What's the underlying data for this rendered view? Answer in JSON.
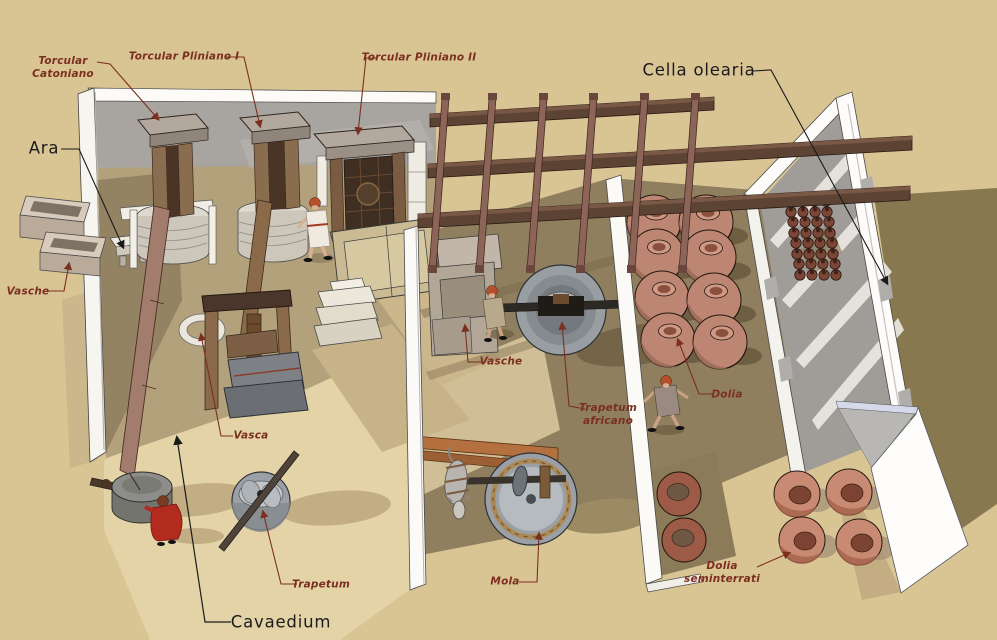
{
  "labels": {
    "torcular_catoniano": {
      "line1": "Torcular",
      "line2": "Catoniano"
    },
    "torcular_pliniano_i": {
      "text": "Torcular Pliniano I"
    },
    "torcular_pliniano_ii": {
      "text": "Torcular Pliniano II"
    },
    "ara": {
      "text": "Ara"
    },
    "vasche_left": {
      "text": "Vasche"
    },
    "vasca": {
      "text": "Vasca"
    },
    "trapetum": {
      "text": "Trapetum"
    },
    "cavaedium": {
      "text": "Cavaedium"
    },
    "vasche_mid": {
      "text": "Vasche"
    },
    "trapetum_africano": {
      "line1": "Trapetum",
      "line2": "africano"
    },
    "mola": {
      "text": "Mola"
    },
    "dolia": {
      "text": "Dolia"
    },
    "dolia_seminterrati": {
      "line1": "Dolia",
      "line2": "seminterrati"
    },
    "cella_olearia": {
      "text": "Cella olearia"
    }
  },
  "colors": {
    "background": "#d9c494",
    "label_red": "#7b2f20",
    "label_black": "#1b1b1b",
    "terracotta": "#bd8672",
    "wall_white": "#fbfaf7",
    "beam_brown": "#5d4334",
    "rafter_brown": "#8d6458",
    "floor_olive": "#8f7f5e",
    "mill_gray": "#9aa0a5",
    "figure_red": "#b32a1e"
  }
}
